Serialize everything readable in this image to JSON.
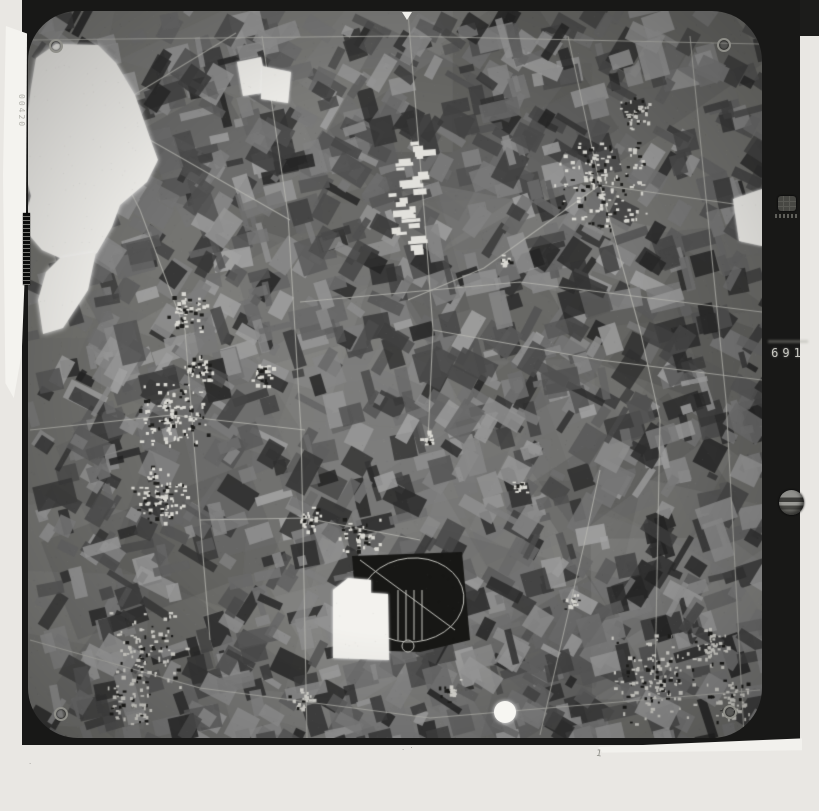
{
  "page": {
    "background": "#e9e7e3"
  },
  "photo": {
    "frame_color": "#181817",
    "edge_number_vertical": "00420",
    "index_number": "691",
    "pencil_marks": {
      "left": ".",
      "center": ". ·",
      "right": "1"
    },
    "palette": {
      "field_base": "#73736f",
      "road": "#b8b8b2",
      "settlement_bright": "#d9d8d2",
      "settlement_dark": "#1e1e1c",
      "woodland_dark": "#171715",
      "cloud_white": "#f5f4f0",
      "blanked_white": "#f3f2ee"
    }
  }
}
